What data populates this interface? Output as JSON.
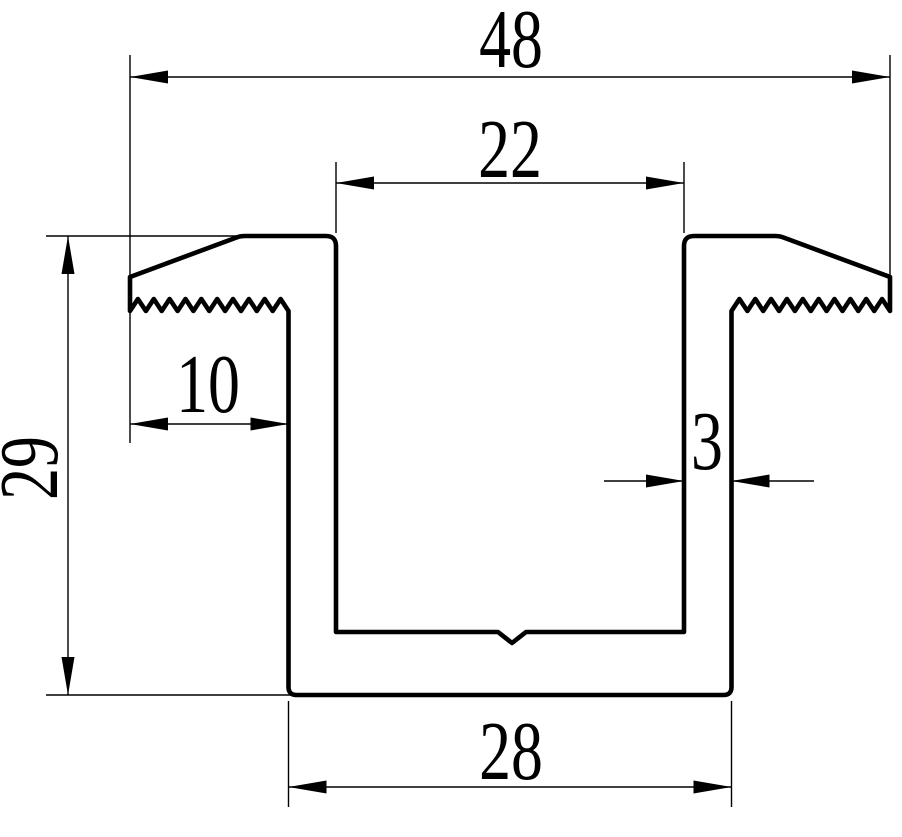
{
  "drawing": {
    "description": "Dimensioned cross-section of a channel profile with serrated clamping flanges",
    "stroke_color": "#000000",
    "background_color": "#ffffff",
    "units_shown": false,
    "dimensions": {
      "overall_width": "48",
      "channel_inner_width": "22",
      "flange_width": "10",
      "wall_thickness": "3",
      "overall_height": "29",
      "base_width": "28"
    }
  }
}
